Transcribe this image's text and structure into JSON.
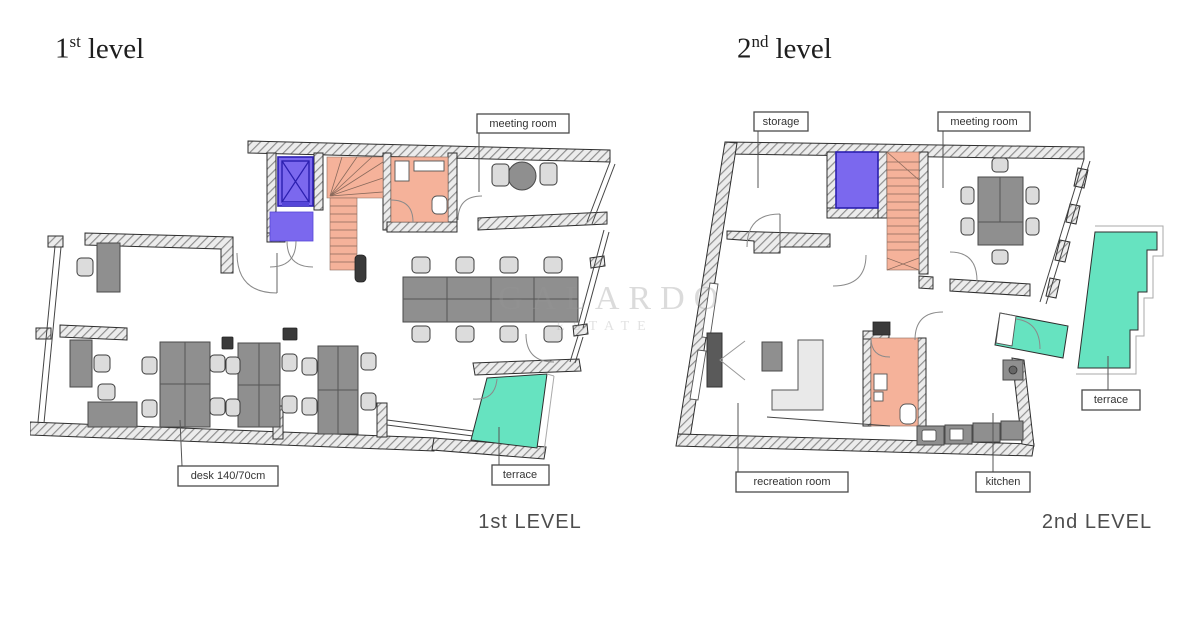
{
  "watermark": {
    "line1": "GALARDO",
    "line2": "ESTATE"
  },
  "level1": {
    "title_number": "1",
    "title_suffix": "st",
    "title_word": "level",
    "caption": "1st LEVEL",
    "labels": {
      "meeting_room": "meeting room",
      "desk": "desk 140/70cm",
      "terrace": "terrace"
    }
  },
  "level2": {
    "title_number": "2",
    "title_suffix": "nd",
    "title_word": "level",
    "caption": "2nd LEVEL",
    "labels": {
      "storage": "storage",
      "meeting_room": "meeting room",
      "terrace": "terrace",
      "recreation_room": "recreation room",
      "kitchen": "kitchen"
    }
  },
  "colors": {
    "elevator": "#7b68ee",
    "stairs": "#f5b29a",
    "terrace": "#66e3c0",
    "furniture_dark": "#8f8f8f",
    "furniture_light": "#dcdcdc"
  }
}
